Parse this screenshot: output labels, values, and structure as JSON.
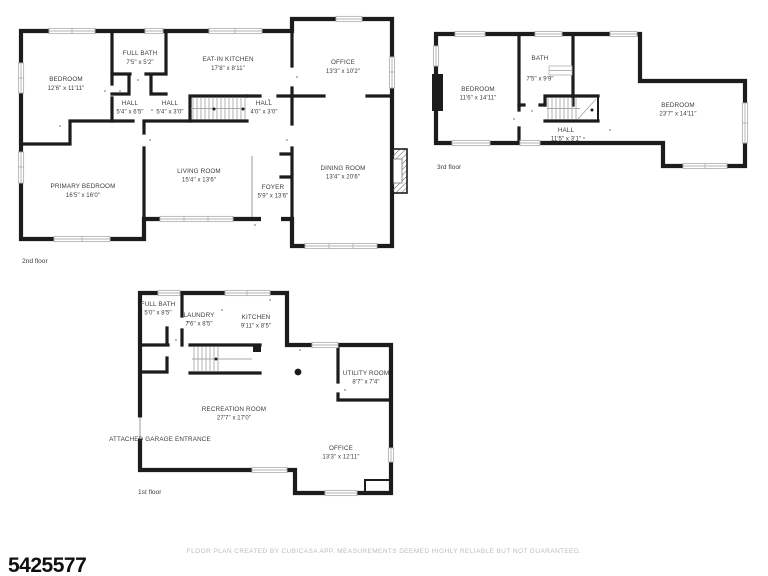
{
  "listing_id": "5425577",
  "footer_disclaimer": "FLOOR PLAN CREATED BY CUBICASA APP. MEASUREMENTS DEEMED HIGHLY RELIABLE BUT NOT GUARANTEED.",
  "colors": {
    "wall": "#1c1c1c",
    "win": "#b3b3b3",
    "text": "#3d3d3d",
    "footer": "#bdbdbd"
  },
  "floors": {
    "second": {
      "label": "2nd floor",
      "rooms": {
        "bedroom": {
          "name": "BEDROOM",
          "dims": "12'6\" x 11'11\""
        },
        "full_bath": {
          "name": "FULL BATH",
          "dims": "7'5\" x 5'2\""
        },
        "eat_in_kitchen": {
          "name": "EAT-IN KITCHEN",
          "dims": "17'8\" x 8'11\""
        },
        "office": {
          "name": "OFFICE",
          "dims": "13'3\" x 10'2\""
        },
        "hall_a": {
          "name": "HALL",
          "dims": "5'4\" x 6'5\""
        },
        "hall_b": {
          "name": "HALL",
          "dims": "5'4\" x 3'0\""
        },
        "hall_c": {
          "name": "HALL",
          "dims": "4'0\" x 3'0\""
        },
        "primary_bedroom": {
          "name": "PRIMARY BEDROOM",
          "dims": "16'5\" x 16'0\""
        },
        "living_room": {
          "name": "LIVING ROOM",
          "dims": "15'4\" x 13'6\""
        },
        "foyer": {
          "name": "FOYER",
          "dims": "5'9\" x 13'6\""
        },
        "dining_room": {
          "name": "DINING ROOM",
          "dims": "13'4\" x 20'6\""
        }
      }
    },
    "third": {
      "label": "3rd floor",
      "rooms": {
        "bedroom_left": {
          "name": "BEDROOM",
          "dims": "11'6\" x 14'11\""
        },
        "bath": {
          "name": "BATH",
          "dims": "7'5\" x 9'9\""
        },
        "hall": {
          "name": "HALL",
          "dims": "11'5\" x 3'1\""
        },
        "bedroom_right": {
          "name": "BEDROOM",
          "dims": "23'7\" x 14'11\""
        }
      }
    },
    "first": {
      "label": "1st floor",
      "rooms": {
        "full_bath": {
          "name": "FULL BATH",
          "dims": "5'0\" x 8'5\""
        },
        "laundry": {
          "name": "LAUNDRY",
          "dims": "7'6\" x 8'5\""
        },
        "kitchen": {
          "name": "KITCHEN",
          "dims": "9'11\" x 8'5\""
        },
        "utility_room": {
          "name": "UTILITY ROOM",
          "dims": "8'7\" x 7'4\""
        },
        "recreation_room": {
          "name": "RECREATION ROOM",
          "dims": "27'7\" x 17'0\""
        },
        "office": {
          "name": "OFFICE",
          "dims": "13'3\" x 12'11\""
        },
        "garage_entrance": {
          "name": "ATTACHED GARAGE ENTRANCE"
        }
      }
    }
  }
}
